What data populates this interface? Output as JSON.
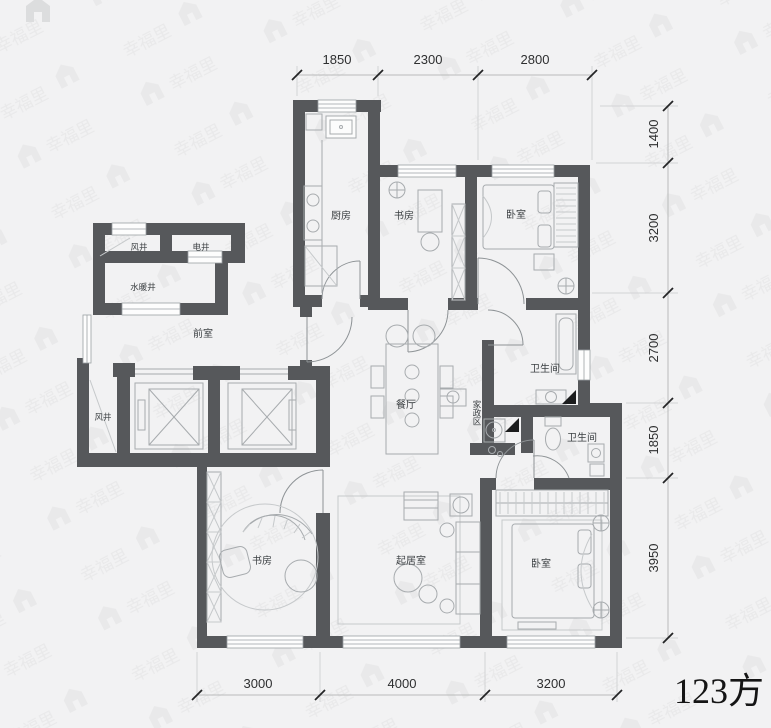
{
  "area_label": "123方",
  "watermark": {
    "brand": "幸福里"
  },
  "rooms": {
    "fengjing_top": "风井",
    "dianjing": "电井",
    "shuinuanjing": "水暖井",
    "qianshi": "前室",
    "chufang": "厨房",
    "shufang_top": "书房",
    "woshi_top": "卧室",
    "weishengjian_1": "卫生间",
    "canting": "餐厅",
    "jiazhengqu": "家政区",
    "weishengjian_2": "卫生间",
    "fengjing_left": "风井",
    "shufang_bottom": "书房",
    "qijushi": "起居室",
    "woshi_bottom": "卧室"
  },
  "dimensions": {
    "top": [
      "1850",
      "2300",
      "2800"
    ],
    "right": [
      "1400",
      "3200",
      "2700",
      "1850",
      "3950"
    ],
    "bottom": [
      "3000",
      "4000",
      "3200"
    ]
  }
}
